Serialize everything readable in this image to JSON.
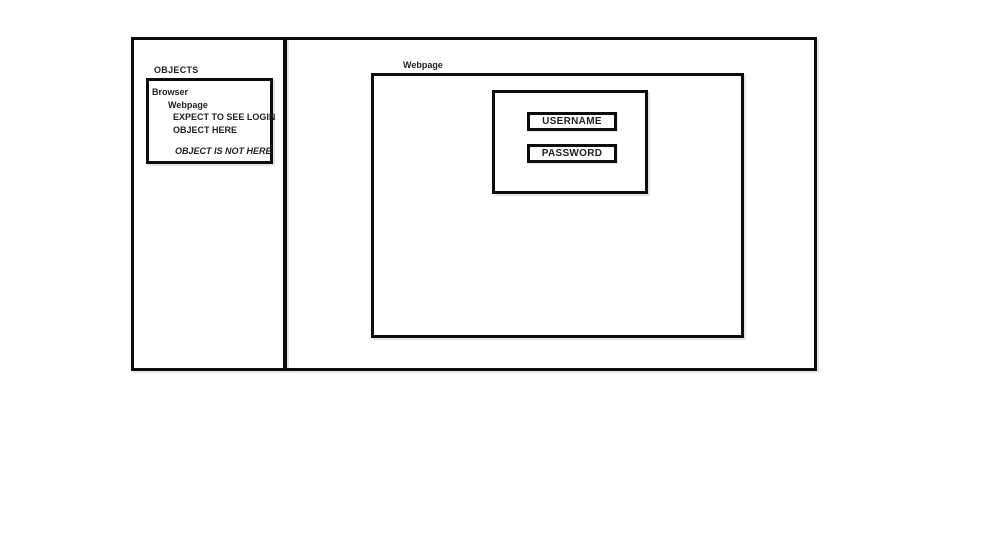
{
  "colors": {
    "line": "#0d0d0d",
    "background": "#ffffff",
    "text": "#1f1f1f"
  },
  "objects_panel": {
    "title": "OBJECTS",
    "tree": {
      "browser": "Browser",
      "webpage": "Webpage",
      "expect_line1": "EXPECT TO SEE LOGIN",
      "expect_line2": "OBJECT HERE",
      "absence_note": "OBJECT IS NOT HERE"
    }
  },
  "webpage_panel": {
    "label": "Webpage",
    "login_form": {
      "username": "USERNAME",
      "password": "PASSWORD"
    }
  }
}
